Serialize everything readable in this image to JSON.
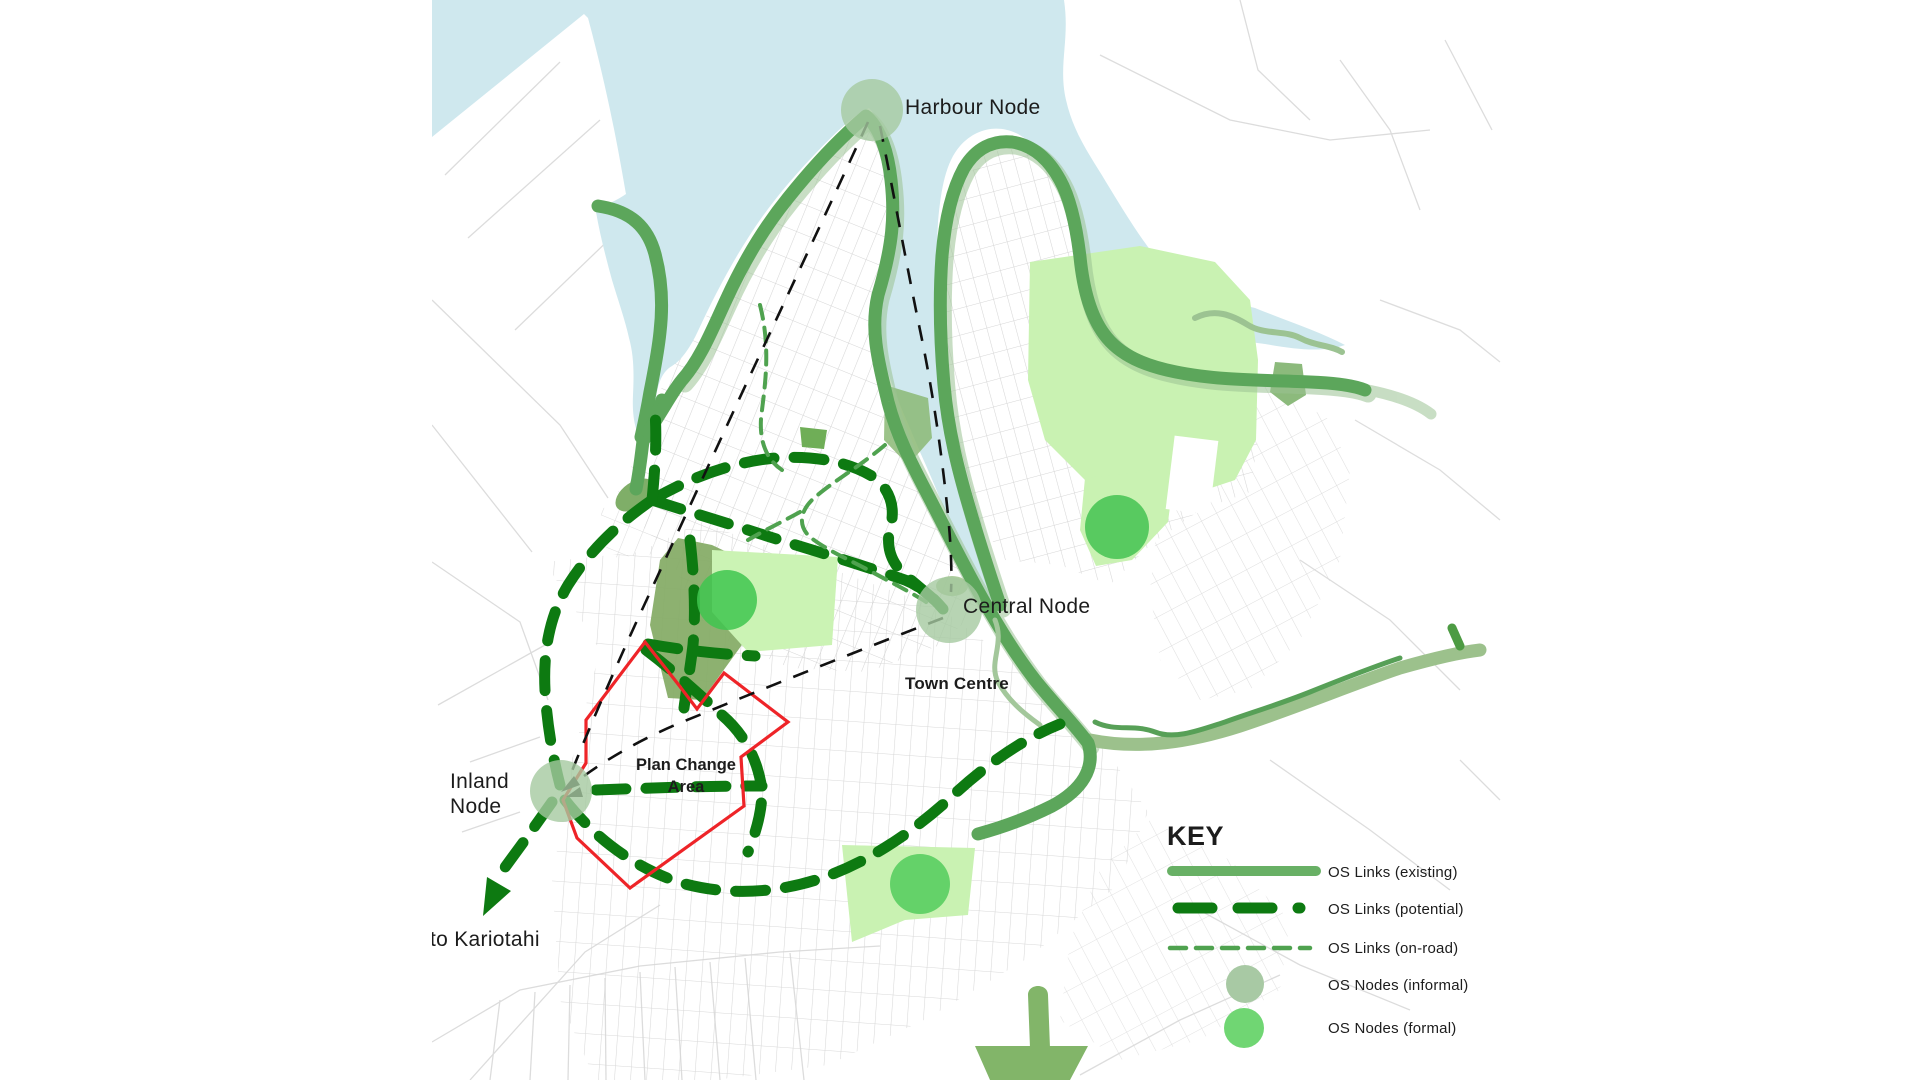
{
  "map": {
    "labels": {
      "harbour_node": "Harbour Node",
      "central_node": "Central Node",
      "inland_node_line1": "Inland",
      "inland_node_line2": "Node",
      "town_centre": "Town Centre",
      "plan_change_line1": "Plan Change",
      "plan_change_line2": "Area",
      "to_kariotahi": "to Kariotahi"
    },
    "colors": {
      "water": "#cfe8ee",
      "land": "#ffffff",
      "street": "#d4d4d4",
      "link_existing": "#5ca65b",
      "link_existing_legend": "#68b065",
      "link_potential": "#0d7a11",
      "link_onroad": "#4fa24f",
      "esplanade_sage": "#9bc393",
      "park_olive": "#83aa64",
      "park_light_green": "#c9f2b2",
      "node_informal": "#a5c9a0",
      "node_formal": "#52cd5c",
      "plan_boundary_red": "#ee2428",
      "connector_black": "#111111"
    }
  },
  "legend": {
    "title": "KEY",
    "items": [
      {
        "id": "existing",
        "label": "OS Links (existing)"
      },
      {
        "id": "potential",
        "label": "OS Links (potential)"
      },
      {
        "id": "onroad",
        "label": "OS Links (on-road)"
      },
      {
        "id": "informal",
        "label": "OS Nodes (informal)"
      },
      {
        "id": "formal",
        "label": "OS Nodes (formal)"
      }
    ]
  }
}
